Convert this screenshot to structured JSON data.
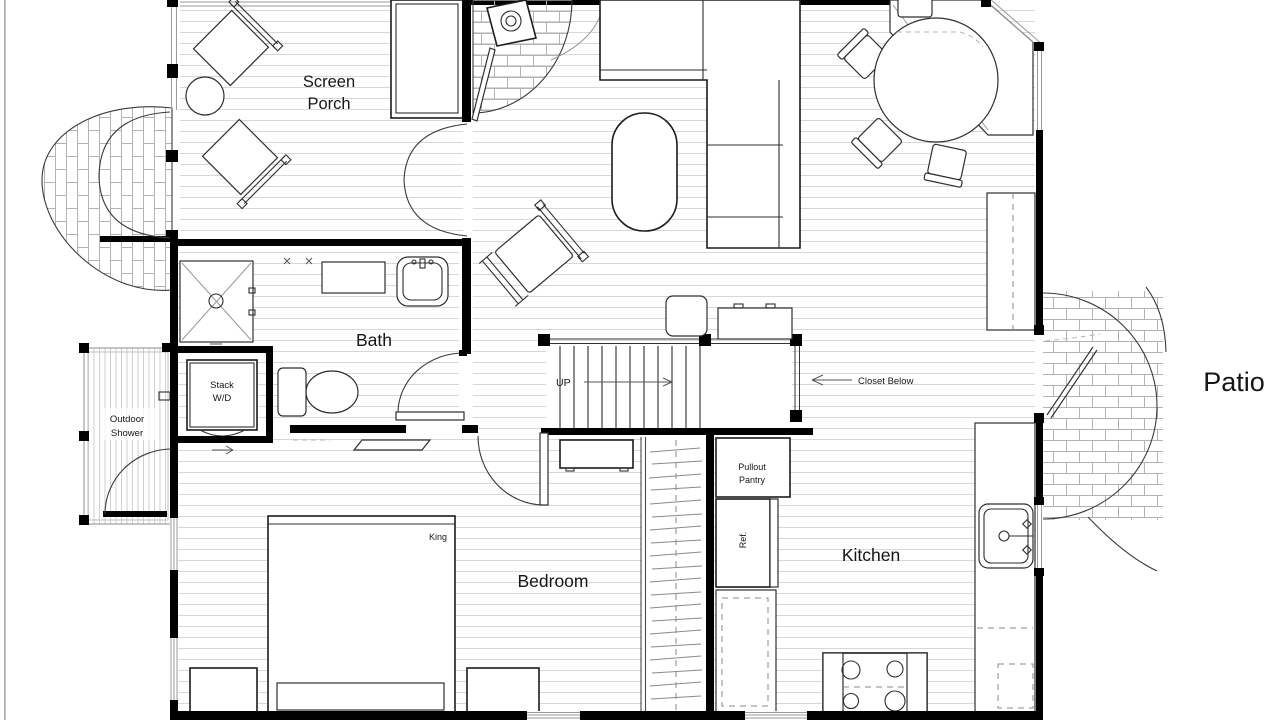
{
  "labels": {
    "screen_porch_1": "Screen",
    "screen_porch_2": "Porch",
    "bath": "Bath",
    "bedroom": "Bedroom",
    "kitchen": "Kitchen",
    "patio": "Patio",
    "outdoor_shower_1": "Outdoor",
    "outdoor_shower_2": "Shower",
    "stack_wd_1": "Stack",
    "stack_wd_2": "W/D",
    "up": "UP",
    "closet_below": "Closet Below",
    "pullout_pantry_1": "Pullout",
    "pullout_pantry_2": "Pantry",
    "ref": "Ref.",
    "king": "King"
  },
  "colors": {
    "wall": "#000000",
    "furniture_line": "#2e2e2e",
    "floor_line": "#d7d7d7",
    "brick_line": "#b3b3b3",
    "annotation": "#555555",
    "text": "#161616"
  }
}
